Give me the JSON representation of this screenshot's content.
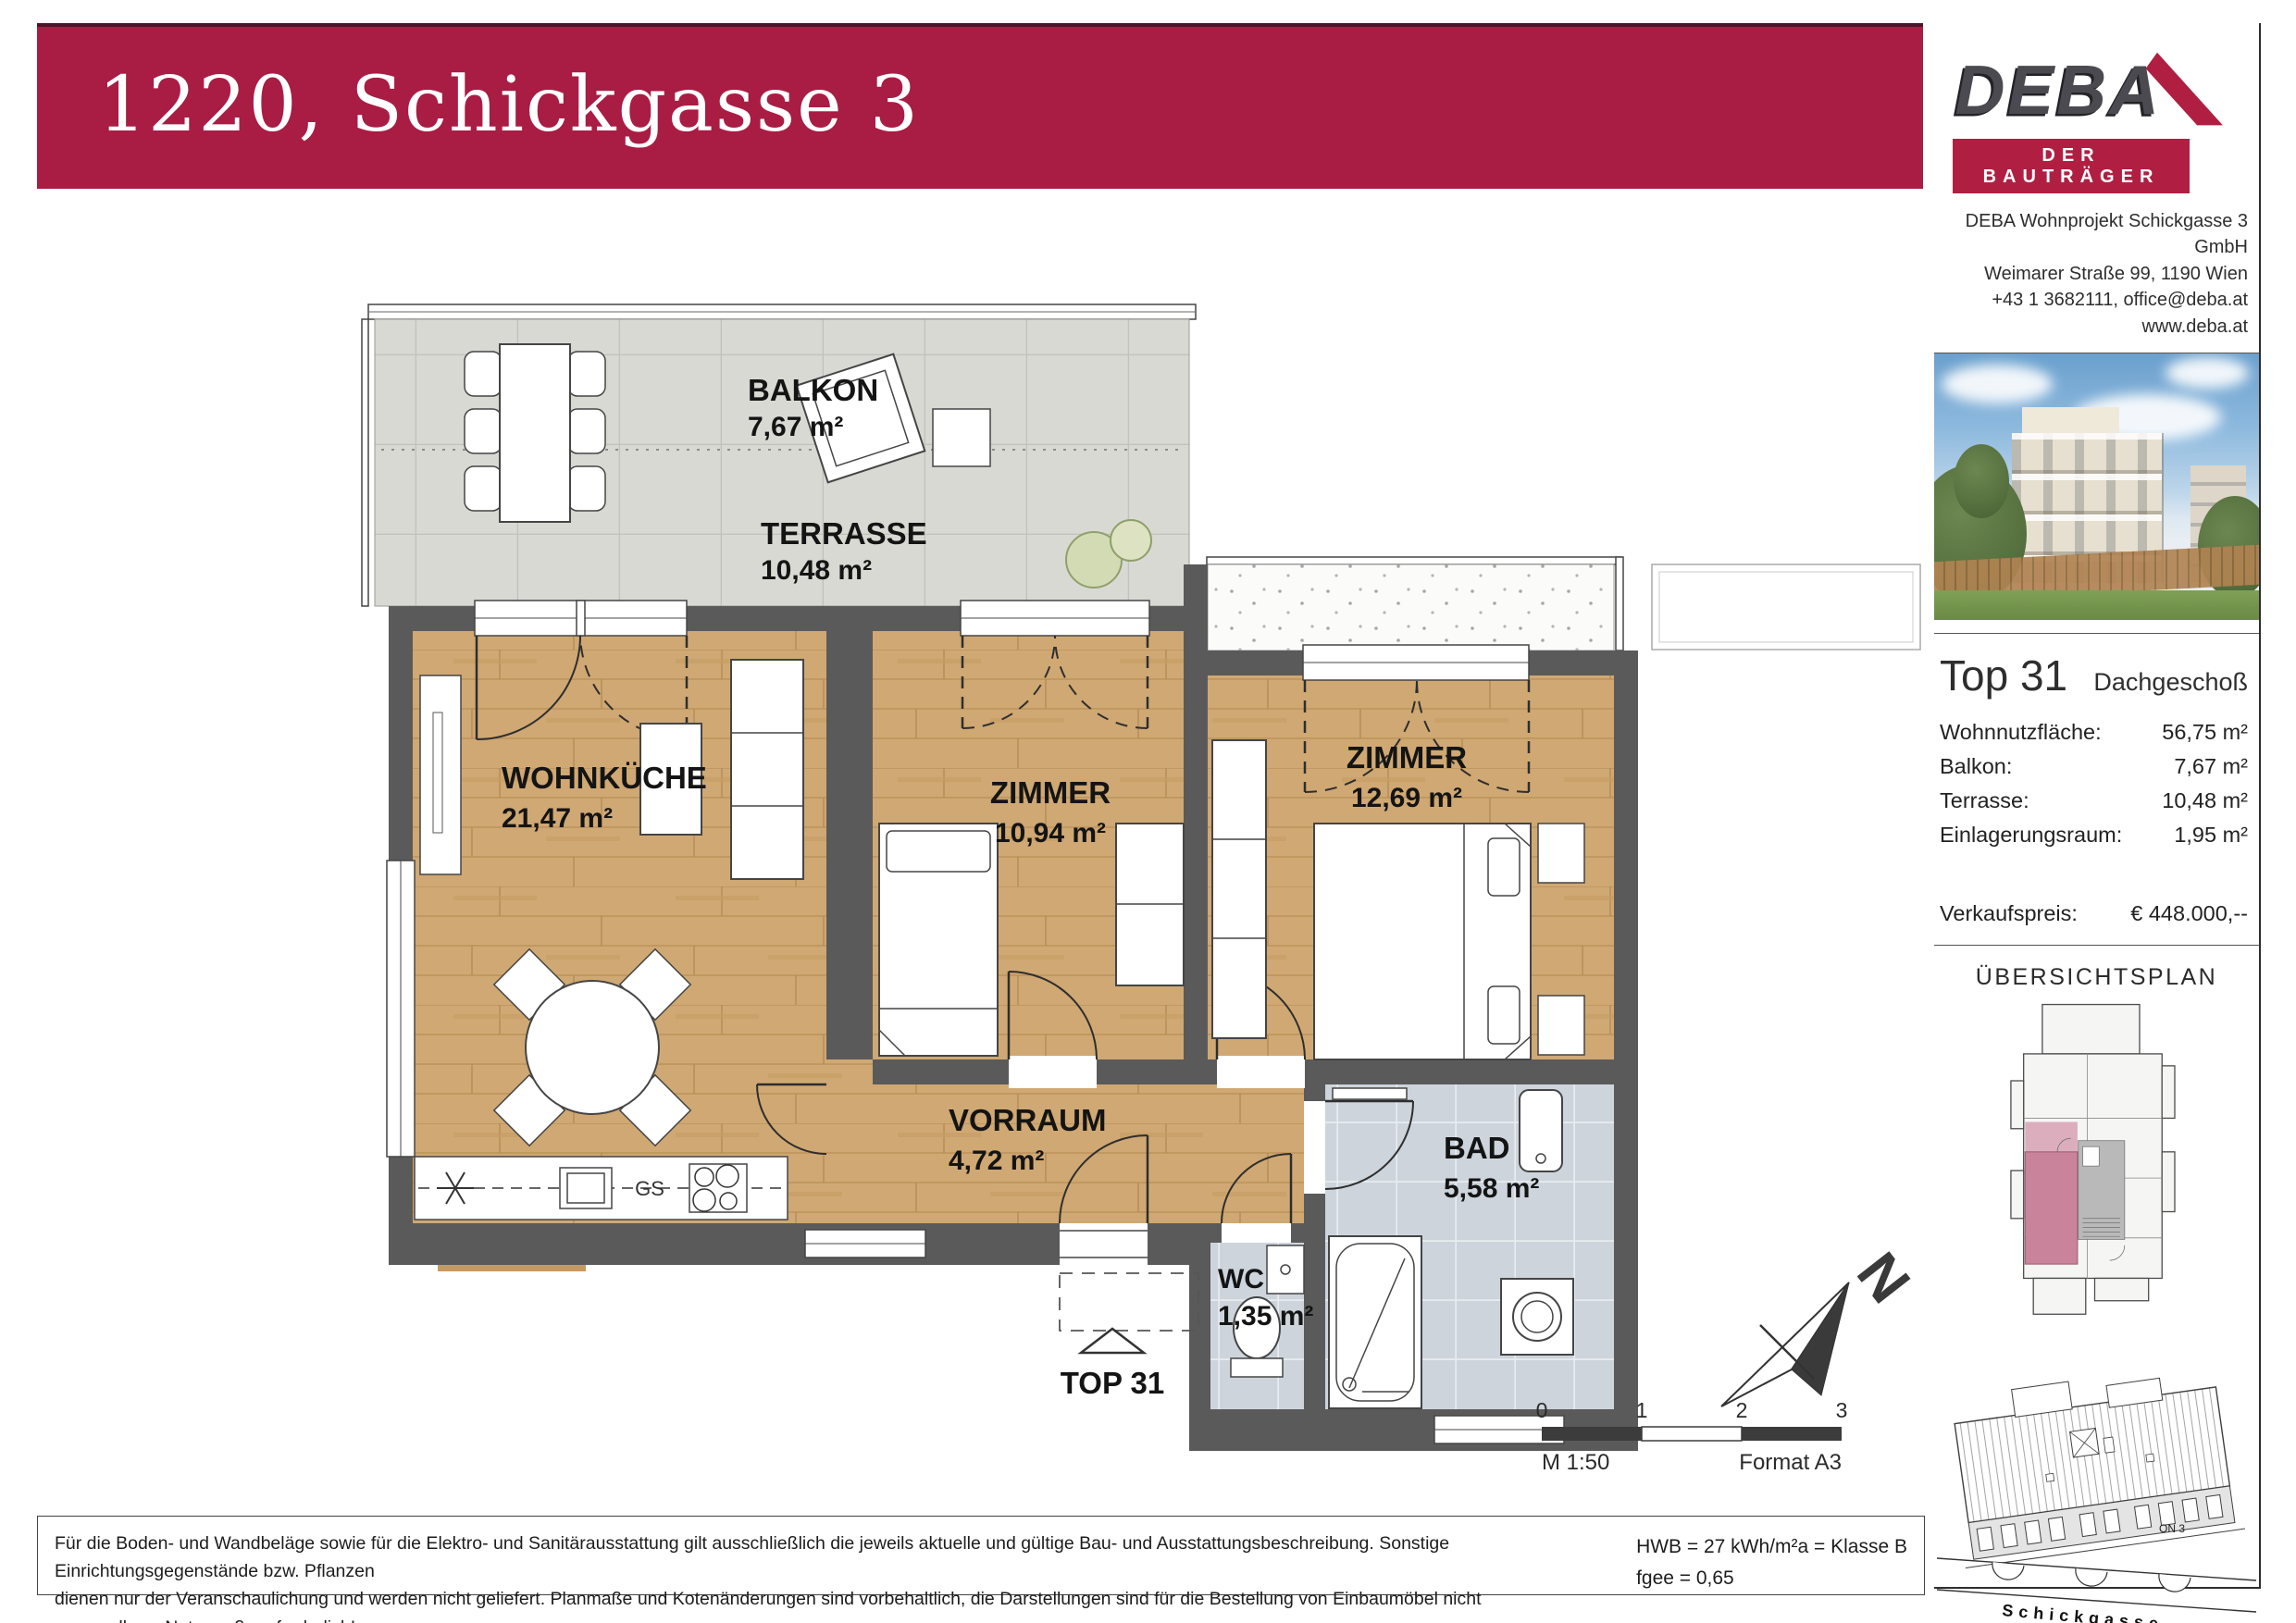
{
  "banner": {
    "title": "1220, Schickgasse 3"
  },
  "colors": {
    "accent": "#A91C44",
    "wall": "#5A5A5A",
    "wood": "#CFA873",
    "tile": "#D9D9D4",
    "bath_tile": "#CDD4DC",
    "unit_highlight": "#C9839B"
  },
  "sidebar": {
    "logo": {
      "name": "DEBA",
      "tagline": "DER BAUTRÄGER"
    },
    "company": {
      "line1": "DEBA Wohnprojekt Schickgasse 3 GmbH",
      "line2": "Weimarer Straße 99, 1190 Wien",
      "line3": "+43 1 3682111, office@deba.at",
      "line4": "www.deba.at"
    },
    "unit": {
      "title": "Top 31",
      "floor": "Dachgeschoß",
      "rows": [
        {
          "label": "Wohnnutzfläche:",
          "value": "56,75 m²"
        },
        {
          "label": "Balkon:",
          "value": "7,67 m²"
        },
        {
          "label": "Terrasse:",
          "value": "10,48 m²"
        },
        {
          "label": "Einlagerungsraum:",
          "value": "1,95 m²"
        }
      ],
      "price_label": "Verkaufspreis:",
      "price_value": "€ 448.000,--"
    },
    "overview_title": "ÜBERSICHTSPLAN",
    "siteplan": {
      "street": "Schickgasse",
      "note": "ON 3"
    }
  },
  "plan": {
    "rooms": [
      {
        "name": "BALKON",
        "area": "7,67 m²"
      },
      {
        "name": "TERRASSE",
        "area": "10,48 m²"
      },
      {
        "name": "WOHNKÜCHE",
        "area": "21,47 m²"
      },
      {
        "name": "ZIMMER",
        "area": "10,94 m²"
      },
      {
        "name": "ZIMMER",
        "area": "12,69 m²"
      },
      {
        "name": "VORRAUM",
        "area": "4,72 m²"
      },
      {
        "name": "WC",
        "area": "1,35 m²"
      },
      {
        "name": "BAD",
        "area": "5,58 m²"
      }
    ],
    "unit_marker": "TOP 31",
    "kitchen": {
      "gs": "GS"
    },
    "north": "N",
    "scale": {
      "ticks": [
        "0",
        "1",
        "2",
        "3"
      ],
      "scale_label": "M 1:50",
      "format_label": "Format A3"
    }
  },
  "footer": {
    "disclaimer_line1": "Für die Boden- und Wandbeläge sowie für die Elektro- und Sanitärausstattung gilt ausschließlich die jeweils aktuelle und gültige Bau- und Ausstattungsbeschreibung. Sonstige Einrichtungsgegenstände bzw. Pflanzen",
    "disclaimer_line2": "dienen nur der Veranschaulichung und werden nicht geliefert. Planmaße und Kotenänderungen sind vorbehaltlich, die Darstellungen sind für die Bestellung von Einbaumöbel nicht verwendbar - Naturmaße erforderlich!",
    "energy_line1": "HWB = 27 kWh/m²a = Klasse B",
    "energy_line2": "fgee = 0,65"
  }
}
